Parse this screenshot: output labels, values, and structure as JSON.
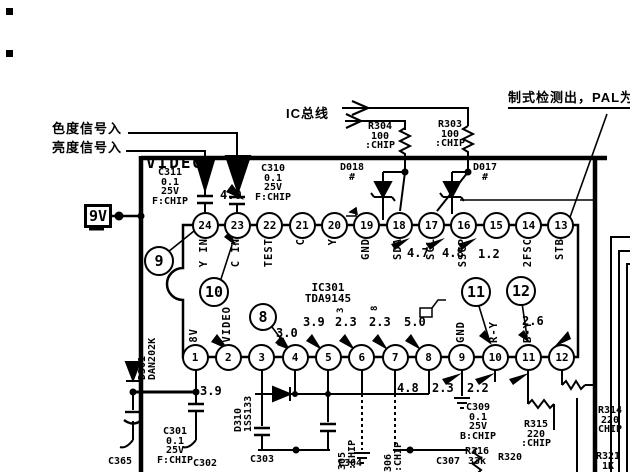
{
  "labels": {
    "chroma_in": "色度信号入",
    "luma_in": "亮度信号入",
    "ic_bus": "IC总线",
    "standard_detect": "制式检测出，PAL为",
    "video_title": "VIDEO",
    "supply": "9V"
  },
  "ic": {
    "ref_block": "IC301\nTDA9145",
    "top_pins": [
      {
        "n": "24",
        "label": "Y IN"
      },
      {
        "n": "23",
        "label": "C IN"
      },
      {
        "n": "22",
        "label": "TEST"
      },
      {
        "n": "21",
        "label": "C"
      },
      {
        "n": "20",
        "label": "Y"
      },
      {
        "n": "19",
        "label": "GND"
      },
      {
        "n": "18",
        "label": "SDA"
      },
      {
        "n": "17",
        "label": "SCL"
      },
      {
        "n": "16",
        "label": "SSCP"
      },
      {
        "n": "15",
        "label": ""
      },
      {
        "n": "14",
        "label": "2FSC"
      },
      {
        "n": "13",
        "label": "STB"
      }
    ],
    "bottom_pins": [
      {
        "n": "1",
        "label": "8V"
      },
      {
        "n": "2",
        "label": "VIDEO"
      },
      {
        "n": "3",
        "label": ""
      },
      {
        "n": "4",
        "label": ""
      },
      {
        "n": "5",
        "label": ""
      },
      {
        "n": "6",
        "label": ""
      },
      {
        "n": "7",
        "label": ""
      },
      {
        "n": "8",
        "label": ""
      },
      {
        "n": "9",
        "label": "GND"
      },
      {
        "n": "10",
        "label": "R-Y"
      },
      {
        "n": "11",
        "label": "B-Y"
      },
      {
        "n": "12",
        "label": ""
      }
    ]
  },
  "callouts": {
    "c9": "9",
    "c10": "10",
    "c8": "8",
    "c11": "11",
    "c12": "12"
  },
  "voltages": {
    "pin23": "4.0",
    "pin18": "4.7",
    "pin17": "4.8",
    "pin16": "1.2",
    "pin2": "3.9",
    "pin4": "3.0",
    "pin5": "3.9",
    "pin6": "2.3",
    "pin7": "2.3",
    "pin8": "5.0",
    "pin9": "4.8",
    "pin10": "2.3",
    "pin11": "2.2",
    "pin12": "2.6"
  },
  "marks": {
    "pin6_mark": "3",
    "pin7_mark": "8"
  },
  "components": {
    "c311": "C311\n0.1\n25V\nF:CHIP",
    "c310": "C310\n0.1\n25V\nF:CHIP",
    "r304": "R304\n100\n:CHIP",
    "r303": "R303\n100\n:CHIP",
    "d018": "D018\n#",
    "d017": "D017\n#",
    "d301": "D301\nDAN202K",
    "d310": "D310\n1SS133",
    "c301": "C301\n0.1\n25V\nF:CHIP",
    "c365": "C365",
    "c302": "C302",
    "c303": "C303",
    "c304": "C304",
    "r305": "305\n:CHIP",
    "r306": "306\n:CHIP",
    "c309": "C309\n0.1\n25V\nB:CHIP",
    "c307": "C307",
    "r316": "R316\n33k",
    "r320": "R320",
    "r315": "R315\n220\n:CHIP",
    "r314": "R314\n220\nCHIP",
    "r321": "R321\n1K"
  }
}
